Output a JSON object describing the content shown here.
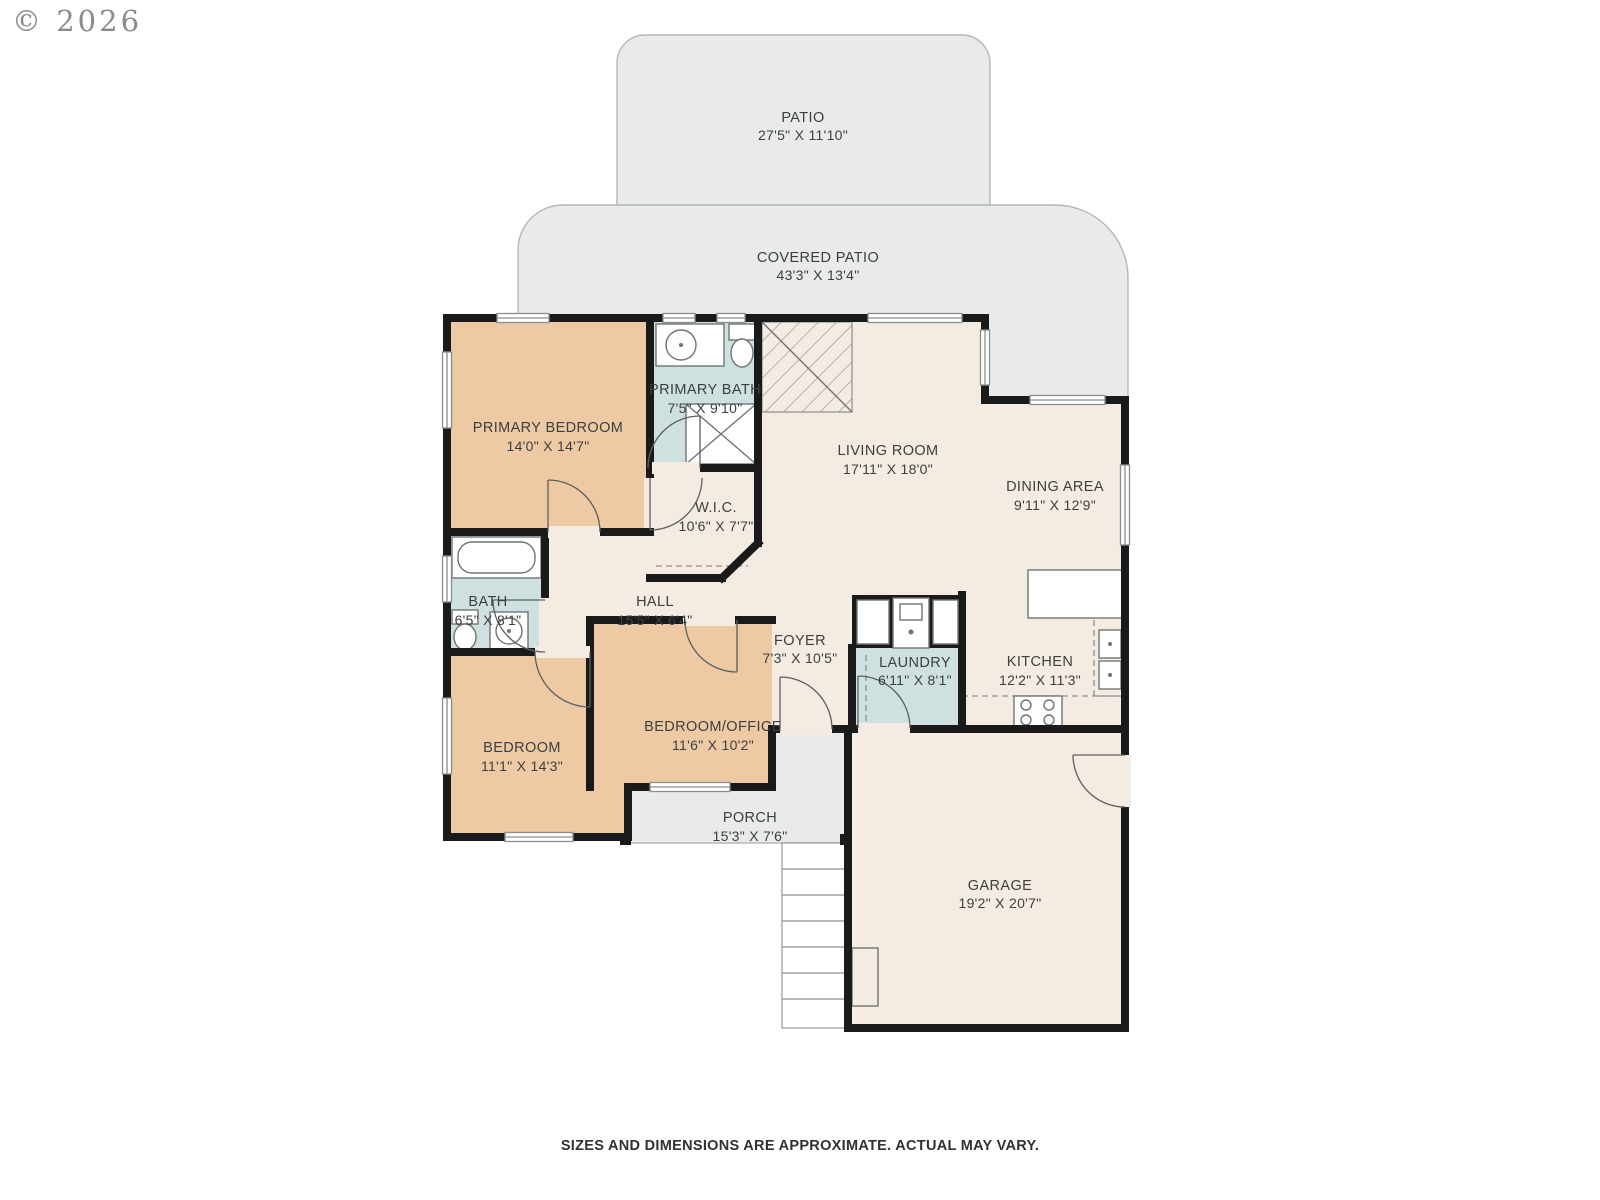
{
  "copyright": "© 2026",
  "disclaimer": "SIZES AND DIMENSIONS ARE APPROXIMATE. ACTUAL MAY VARY.",
  "rooms": {
    "patio": {
      "name": "PATIO",
      "dims": "27'5\" X 11'10\""
    },
    "covered_patio": {
      "name": "COVERED PATIO",
      "dims": "43'3\" X 13'4\""
    },
    "primary_bedroom": {
      "name": "PRIMARY BEDROOM",
      "dims": "14'0\" X 14'7\""
    },
    "primary_bath": {
      "name": "PRIMARY BATH",
      "dims": "7'5\" X 9'10\""
    },
    "living_room": {
      "name": "LIVING ROOM",
      "dims": "17'11\" X 18'0\""
    },
    "dining_area": {
      "name": "DINING AREA",
      "dims": "9'11\" X 12'9\""
    },
    "wic": {
      "name": "W.I.C.",
      "dims": "10'6\" X 7'7\""
    },
    "bath": {
      "name": "BATH",
      "dims": "6'5\" X 8'1\""
    },
    "hall": {
      "name": "HALL",
      "dims": "15'5\" X 6'4\""
    },
    "foyer": {
      "name": "FOYER",
      "dims": "7'3\" X 10'5\""
    },
    "laundry": {
      "name": "LAUNDRY",
      "dims": "6'11\" X 8'1\""
    },
    "kitchen": {
      "name": "KITCHEN",
      "dims": "12'2\" X 11'3\""
    },
    "bedroom": {
      "name": "BEDROOM",
      "dims": "11'1\" X 14'3\""
    },
    "bedroom_office": {
      "name": "BEDROOM/OFFICE",
      "dims": "11'6\" X 10'2\""
    },
    "porch": {
      "name": "PORCH",
      "dims": "15'3\" X 7'6\""
    },
    "garage": {
      "name": "GARAGE",
      "dims": "19'2\" X 20'7\""
    }
  },
  "colors": {
    "wall": "#1a1a1a",
    "interior": "#f4ebe2",
    "bedroom": "#edc9a4",
    "bath": "#cfe0e1",
    "outdoor": "#e9eaea",
    "outline": "#b4b8b8",
    "text": "#3c4040",
    "muted": "#878c8c",
    "fixture": "#6f7473"
  }
}
